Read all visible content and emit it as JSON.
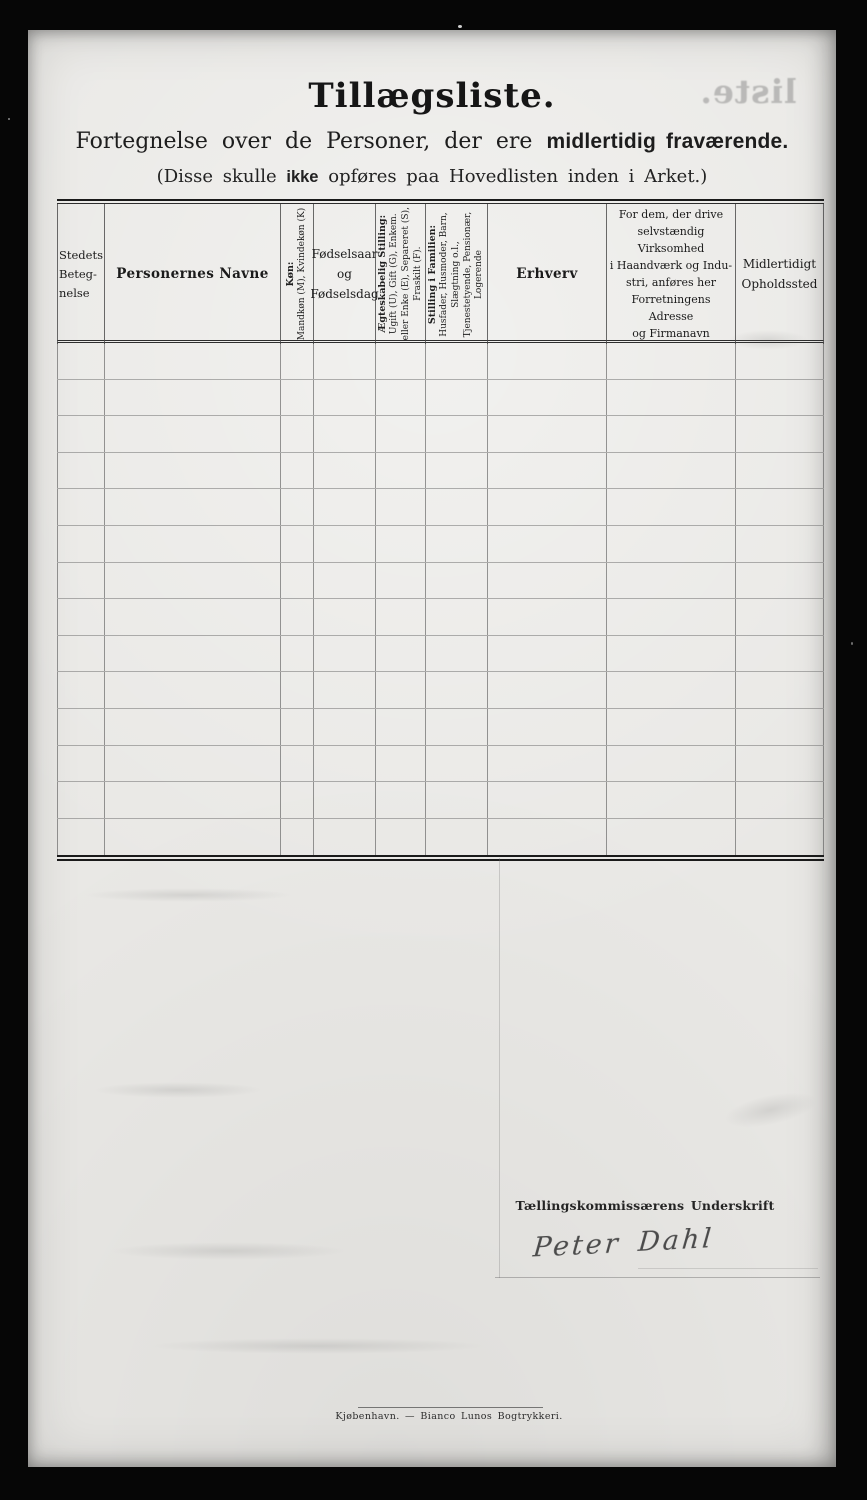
{
  "header": {
    "title": "Tillægsliste.",
    "subtitle_regular": "Fortegnelse over de Personer, der ere",
    "subtitle_bold": "midlertidig fraværende.",
    "note_prefix": "(Disse skulle",
    "note_bold": "ikke",
    "note_suffix": "opføres paa Hovedlisten inden i Arket.)"
  },
  "bleed": {
    "mirrored_text": "liste."
  },
  "table": {
    "columns": [
      {
        "id": "stedets-betegnelse",
        "orientation": "horizontal",
        "lines": [
          "Stedets",
          "Beteg-",
          "nelse"
        ]
      },
      {
        "id": "personernes-navne",
        "orientation": "horizontal",
        "lines": [
          "Personernes Navne"
        ]
      },
      {
        "id": "koen",
        "orientation": "vertical",
        "lines": [
          "Køn:",
          "Mandkøn (M), Kvindekøn (K)"
        ]
      },
      {
        "id": "foedselsaar-og-foedselsdag",
        "orientation": "horizontal",
        "lines": [
          "Fødselsaar",
          "og",
          "Fødselsdag"
        ]
      },
      {
        "id": "aegteskabelig-stilling",
        "orientation": "vertical",
        "lines": [
          "Ægteskabelig Stilling:",
          "Ugift (U), Gift (G), Enkem.",
          "eller Enke (E), Separeret (S),",
          "Fraskilt (F)."
        ]
      },
      {
        "id": "stilling-i-familien",
        "orientation": "vertical",
        "lines": [
          "Stilling i Familien:",
          "Husfader, Husmoder, Barn,",
          "Slægtning o.l.,",
          "Tjenestetyende, Pensionær,",
          "Logerende"
        ]
      },
      {
        "id": "erhverv",
        "orientation": "horizontal",
        "lines": [
          "Erhverv"
        ]
      },
      {
        "id": "virksomhed-adresse",
        "orientation": "horizontal",
        "lines": [
          "For dem, der drive",
          "selvstændig Virksomhed",
          "i Haandværk og Indu-",
          "stri, anføres her",
          "Forretningens Adresse",
          "og Firmanavn"
        ]
      },
      {
        "id": "midlertidigt-opholdssted",
        "orientation": "horizontal",
        "lines": [
          "Midlertidigt",
          "Opholdssted"
        ]
      }
    ],
    "empty_row_count": 14
  },
  "signature": {
    "label": "Tællingskommissærens Underskrift",
    "name": "Peter Dahl"
  },
  "footer": {
    "imprint": "Kjøbenhavn. — Bianco Lunos Bogtrykkeri."
  },
  "colors": {
    "scan_background": "#060606",
    "paper": "#e9e8e5",
    "ink": "#1b1b1b"
  }
}
